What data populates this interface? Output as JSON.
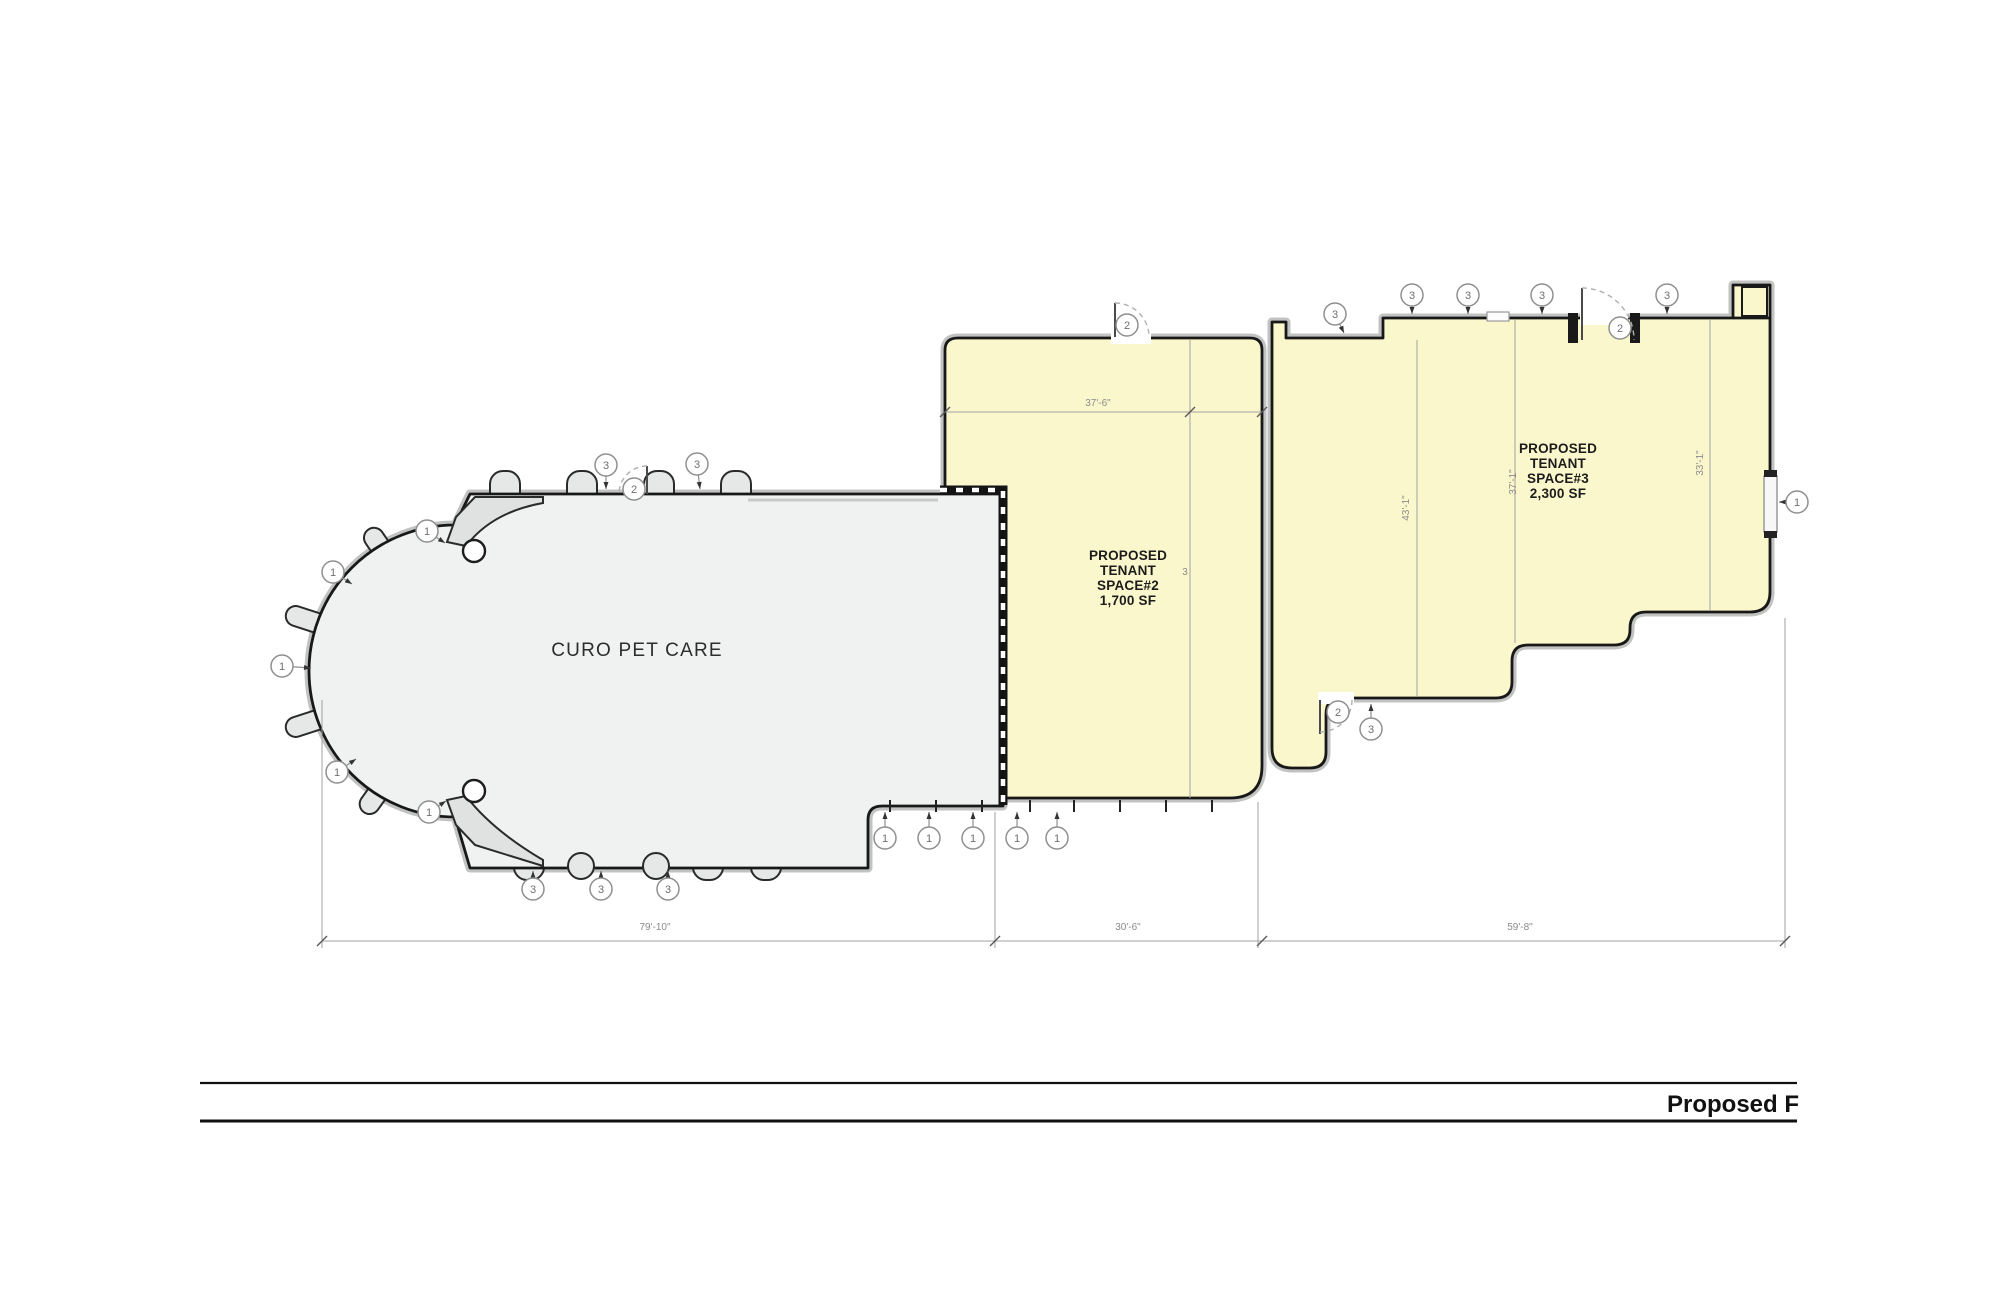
{
  "title_block": {
    "label": "Proposed F"
  },
  "plan": {
    "spaces": [
      {
        "id": "curo",
        "label_lines": [
          "CURO PET CARE"
        ],
        "fill": "#f0f2f1"
      },
      {
        "id": "space2",
        "label_lines": [
          "PROPOSED",
          "TENANT",
          "SPACE#2",
          "1,700 SF"
        ],
        "fill": "#fbf7cc"
      },
      {
        "id": "space3",
        "label_lines": [
          "PROPOSED",
          "TENANT",
          "SPACE#3",
          "2,300 SF"
        ],
        "fill": "#fbf7cc"
      }
    ],
    "colors": {
      "wall": "#181818",
      "wall_halo": "#c1c3c1",
      "dimension": "#8a8a8a",
      "keynote_stroke": "#8f8f8f",
      "keynote_text": "#6f6f6f",
      "space_yellow": "#fbf7cc",
      "space_gray": "#f0f2f1"
    },
    "dimensions": [
      {
        "text": "79'-10\"",
        "x": 655,
        "y": 930,
        "rotate": 0
      },
      {
        "text": "30'-6\"",
        "x": 1128,
        "y": 930,
        "rotate": 0
      },
      {
        "text": "59'-8\"",
        "x": 1520,
        "y": 930,
        "rotate": 0
      },
      {
        "text": "37'-6\"",
        "x": 1098,
        "y": 406,
        "rotate": 0
      },
      {
        "text": "43'-1\"",
        "x": 1409,
        "y": 508,
        "rotate": -90
      },
      {
        "text": "37'-1\"",
        "x": 1516,
        "y": 482,
        "rotate": -90
      },
      {
        "text": "33'-1\"",
        "x": 1703,
        "y": 463,
        "rotate": -90
      },
      {
        "text": "3",
        "x": 1185,
        "y": 575,
        "rotate": 0
      }
    ],
    "keynotes": [
      {
        "label": "1",
        "x": 427,
        "y": 531,
        "tx": 445,
        "ty": 543
      },
      {
        "label": "1",
        "x": 333,
        "y": 572,
        "tx": 352,
        "ty": 584
      },
      {
        "label": "1",
        "x": 282,
        "y": 666,
        "tx": 311,
        "ty": 668
      },
      {
        "label": "1",
        "x": 337,
        "y": 772,
        "tx": 356,
        "ty": 759
      },
      {
        "label": "1",
        "x": 429,
        "y": 812,
        "tx": 446,
        "ty": 801
      },
      {
        "label": "3",
        "x": 606,
        "y": 465,
        "tx": 606,
        "ty": 489
      },
      {
        "label": "2",
        "x": 634,
        "y": 489
      },
      {
        "label": "3",
        "x": 697,
        "y": 464,
        "tx": 700,
        "ty": 489
      },
      {
        "label": "3",
        "x": 533,
        "y": 889,
        "tx": 533,
        "ty": 871
      },
      {
        "label": "3",
        "x": 601,
        "y": 889,
        "tx": 601,
        "ty": 871
      },
      {
        "label": "3",
        "x": 668,
        "y": 889,
        "tx": 668,
        "ty": 871
      },
      {
        "label": "1",
        "x": 885,
        "y": 838,
        "tx": 885,
        "ty": 812
      },
      {
        "label": "1",
        "x": 929,
        "y": 838,
        "tx": 929,
        "ty": 812
      },
      {
        "label": "1",
        "x": 973,
        "y": 838,
        "tx": 973,
        "ty": 812
      },
      {
        "label": "1",
        "x": 1017,
        "y": 838,
        "tx": 1017,
        "ty": 812
      },
      {
        "label": "1",
        "x": 1057,
        "y": 838,
        "tx": 1057,
        "ty": 812
      },
      {
        "label": "2",
        "x": 1127,
        "y": 325
      },
      {
        "label": "2",
        "x": 1338,
        "y": 712
      },
      {
        "label": "3",
        "x": 1371,
        "y": 729,
        "tx": 1371,
        "ty": 704
      },
      {
        "label": "3",
        "x": 1335,
        "y": 314,
        "tx": 1344,
        "ty": 333
      },
      {
        "label": "3",
        "x": 1412,
        "y": 295,
        "tx": 1412,
        "ty": 314
      },
      {
        "label": "3",
        "x": 1468,
        "y": 295,
        "tx": 1468,
        "ty": 314
      },
      {
        "label": "3",
        "x": 1542,
        "y": 295,
        "tx": 1542,
        "ty": 314
      },
      {
        "label": "2",
        "x": 1620,
        "y": 328
      },
      {
        "label": "3",
        "x": 1667,
        "y": 295,
        "tx": 1667,
        "ty": 314
      },
      {
        "label": "1",
        "x": 1797,
        "y": 502,
        "tx": 1779,
        "ty": 502
      }
    ]
  }
}
